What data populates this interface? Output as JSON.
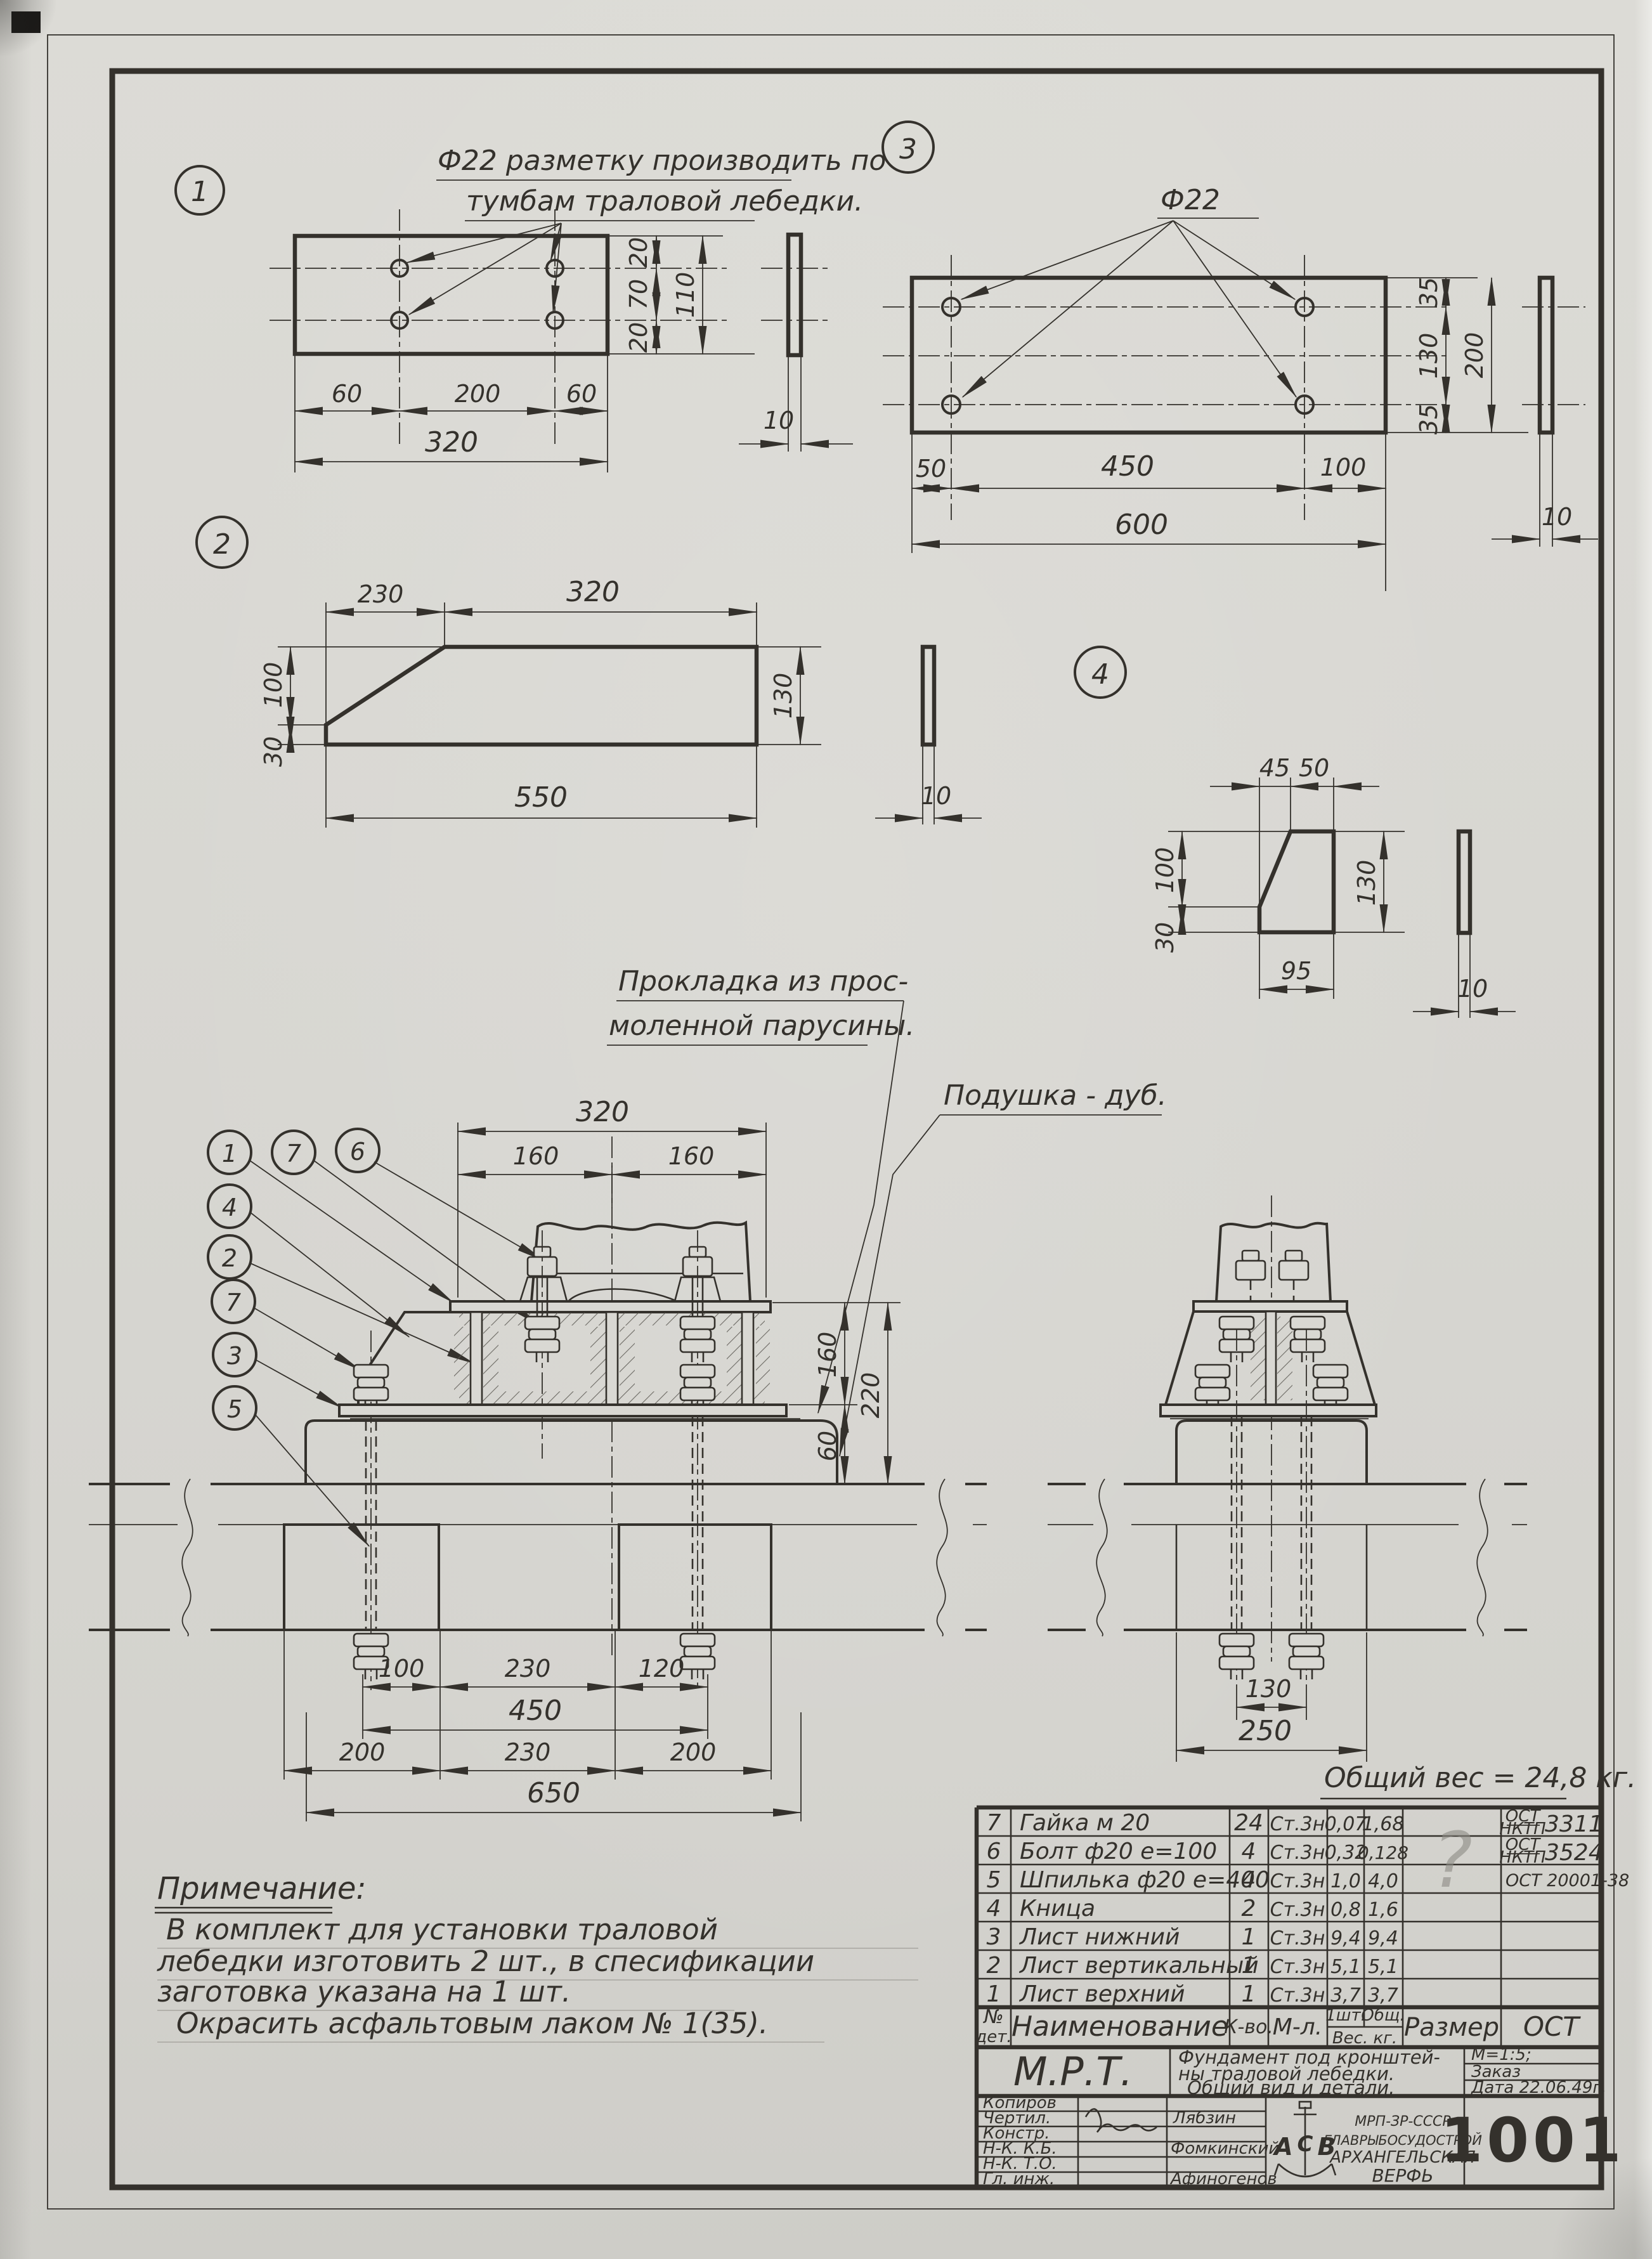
{
  "drawing": {
    "weight_note": "Общий вес = 24,8 кг.",
    "labels": {
      "gasket1": "Прокладка из прос-",
      "gasket2": "моленной парусины.",
      "cushion": "Подушка - дуб."
    },
    "balloons_main": [
      "1",
      "7",
      "6",
      "4",
      "2",
      "7",
      "3",
      "5"
    ]
  },
  "detail1": {
    "balloon": "1",
    "note1": "Ф22 разметку производить по",
    "note2": "тумбам траловой лебедки.",
    "dims": {
      "b1": "60",
      "b2": "200",
      "b3": "60",
      "total": "320",
      "v1": "20",
      "v2": "70",
      "v3": "20",
      "vtotal": "110",
      "thk": "10"
    }
  },
  "detail2": {
    "balloon": "2",
    "dims": {
      "t1": "230",
      "t2": "320",
      "l1": "100",
      "l2": "30",
      "r": "130",
      "total": "550",
      "thk": "10"
    }
  },
  "detail3": {
    "balloon": "3",
    "hole": "Ф22",
    "dims": {
      "b1": "50",
      "b2": "450",
      "b3": "100",
      "total": "600",
      "v1": "35",
      "v2": "130",
      "v3": "35",
      "vtotal": "200",
      "thk": "10"
    }
  },
  "detail4": {
    "balloon": "4",
    "dims": {
      "t1": "45",
      "t2": "50",
      "l1": "100",
      "l2": "30",
      "r": "130",
      "total": "95",
      "thk": "10"
    }
  },
  "main_view": {
    "dims": {
      "top": "320",
      "left": "160",
      "right": "160",
      "h_web": "160",
      "h_total": "220",
      "h_cushion": "60",
      "r1a": "100",
      "r1b": "230",
      "r1c": "120",
      "r2": "450",
      "r3a": "200",
      "r3b": "230",
      "r3c": "200",
      "r4": "650"
    }
  },
  "side_view": {
    "dims": {
      "studs": "130",
      "base": "250"
    }
  },
  "notes": {
    "heading": "Примечание:",
    "line1": "В комплект для установки траловой",
    "line2": "лебедки изготовить 2 шт., в спесификации",
    "line3": "заготовка указана на 1 шт.",
    "line4": "Окрасить асфальтовым лаком № 1(35)."
  },
  "parts_table": {
    "headers": {
      "no1": "№",
      "no2": "дет.",
      "name": "Наименование",
      "qty": "К-во.",
      "mat": "М-л.",
      "w_unit": "1шт.",
      "w_total": "Общ.",
      "w_label": "Вес. кг.",
      "size": "Размер",
      "ost": "ОСТ"
    },
    "rows": [
      {
        "no": "7",
        "name": "Гайка м 20",
        "qty": "24",
        "mat": "Ст.3н",
        "w1": "0,07",
        "wt": "1,68",
        "ost_top": "ОСТ",
        "ost_bot": "НКТП",
        "ost_num": "3311"
      },
      {
        "no": "6",
        "name": "Болт ф20 е=100",
        "qty": "4",
        "mat": "Ст.3н",
        "w1": "0,32",
        "wt": "0,128",
        "ost_top": "ОСТ",
        "ost_bot": "НКТП",
        "ost_num": "3524"
      },
      {
        "no": "5",
        "name": "Шпилька ф20 е=400",
        "qty": "4",
        "mat": "Ст.3н",
        "w1": "1,0",
        "wt": "4,0",
        "ost_single": "ОСТ 20001-38"
      },
      {
        "no": "4",
        "name": "Кница",
        "qty": "2",
        "mat": "Ст.3н",
        "w1": "0,8",
        "wt": "1,6"
      },
      {
        "no": "3",
        "name": "Лист нижний",
        "qty": "1",
        "mat": "Ст.3н",
        "w1": "9,4",
        "wt": "9,4"
      },
      {
        "no": "2",
        "name": "Лист вертикальный",
        "qty": "1",
        "mat": "Ст.3н",
        "w1": "5,1",
        "wt": "5,1"
      },
      {
        "no": "1",
        "name": "Лист верхний",
        "qty": "1",
        "mat": "Ст.3н",
        "w1": "3,7",
        "wt": "3,7"
      }
    ],
    "pencil_mark": "?"
  },
  "title_block": {
    "series": "М.Р.Т.",
    "title1": "Фундамент под кронштей-",
    "title2": "ны траловой лебедки.",
    "title3": "Общий вид и детали.",
    "scale": "М=1:5;",
    "order": "Заказ",
    "date": "Дата 22.06.49г.",
    "sig_labels": [
      "Копиров",
      "Чертил.",
      "Констр.",
      "Н-К. К.Б.",
      "Н-К. Т.О.",
      "Гл. инж."
    ],
    "sig_names": {
      "drafted": "Лябзин",
      "checked": "Фомкинский",
      "chief": "Афиногенов"
    },
    "org": {
      "emblem": "АСВ",
      "line1": "МРП-ЗР-СССР",
      "line2": "ГЛАВРЫБОСУДОСТРОЙ",
      "line3": "АРХАНГЕЛЬСКАЯ",
      "line4": "ВЕРФЬ"
    },
    "number": "1001"
  }
}
